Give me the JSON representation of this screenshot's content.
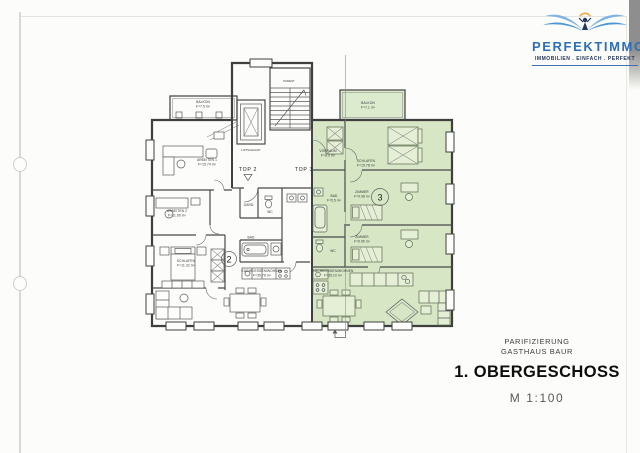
{
  "brand": {
    "name": "PERFEKTIMMO",
    "tagline": "IMMOBILIEN . EINFACH . PERFEKT"
  },
  "title_block": {
    "project": "PARIFIZIERUNG",
    "building": "GASTHAUS BAUR",
    "floor": "1. OBERGESCHOSS",
    "scale": "M 1:100"
  },
  "floorplan": {
    "stair": {
      "podest": "PODEST",
      "lift": "LIFTSCHACHT"
    },
    "top2": {
      "label": "TOP 2",
      "number": "2",
      "balkon": {
        "name": "BALKON",
        "area": "F=7.5 m²"
      },
      "arbeiten1": {
        "name": "ARBEITEN 1",
        "area": "F=15.74 m²"
      },
      "arbeiten2": {
        "name": "ARBEITEN 2",
        "area": "F=11.96 m²"
      },
      "schlafen": {
        "name": "SCHLAFEN",
        "area": "F=11.32 m²"
      },
      "garderobe": {
        "name": "GARD."
      },
      "wc": {
        "name": "WC"
      },
      "bad": {
        "name": "BAD"
      },
      "wohnen": {
        "name": "KÜCHE/ESSEN/WOHNEN",
        "area": "F=35.76 m²"
      }
    },
    "top3": {
      "label": "TOP 3",
      "number": "3",
      "balkon": {
        "name": "BALKON",
        "area": "F=7.1 m²"
      },
      "schlafen": {
        "name": "SCHLAFEN",
        "area": "F=15.78 m²"
      },
      "zimmer1": {
        "name": "ZIMMER",
        "area": "F=9.98 m²"
      },
      "zimmer2": {
        "name": "ZIMMER",
        "area": "F=9.96 m²"
      },
      "vorraum": {
        "name": "VORRAUM",
        "area": "F=8.9 m²"
      },
      "bad": {
        "name": "BAD",
        "area": "F=5.5 m²"
      },
      "wc": {
        "name": "WC"
      },
      "wohnen": {
        "name": "KÜCHE/ESSEN/WOHNEN",
        "area": "F=35.10 m²"
      }
    }
  },
  "colors": {
    "highlight_green": "#d7e7c6",
    "brand_blue": "#2f6fb3",
    "brand_navy": "#24365c",
    "accent_sun": "#f0a63c",
    "wall": "#3f3f3f"
  }
}
